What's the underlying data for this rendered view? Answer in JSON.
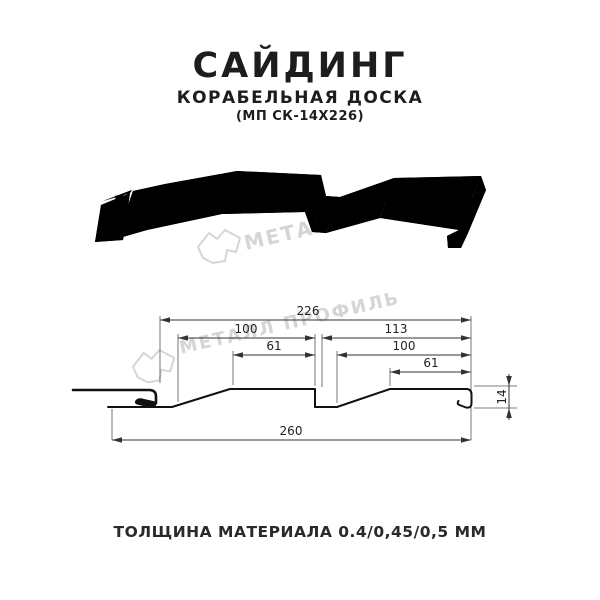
{
  "header": {
    "title": "САЙДИНГ",
    "subtitle": "КОРАБЕЛЬНАЯ ДОСКА",
    "model": "(МП СК-14Х226)"
  },
  "footer": {
    "text": "ТОЛЩИНА МАТЕРИАЛА 0.4/0,45/0,5 ММ"
  },
  "watermark": {
    "text": "МЕТАЛЛ ПРОФИЛЬ",
    "color": "#d5d5d5"
  },
  "drawing": {
    "kind": "siding panel — perspective view and dimensioned cross-section",
    "dimensions_mm": {
      "overall_top": "226",
      "left_pitch": "100",
      "right_pitch": "113",
      "left_flat": "61",
      "right_inner_pitch": "100",
      "right_flat": "61",
      "overall_bottom": "260",
      "depth": "14"
    }
  },
  "colors": {
    "line": "#1a1a1a",
    "dimension": "#333333",
    "text": "#1f1f1f",
    "watermark": "#d5d5d5",
    "background": "#ffffff"
  }
}
